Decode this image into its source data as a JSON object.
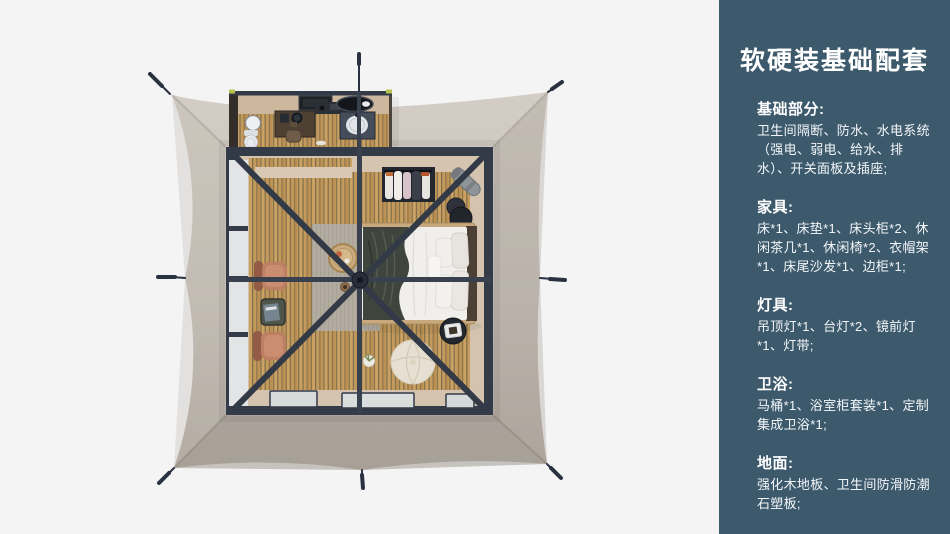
{
  "panel": {
    "title": "软硬装基础配套",
    "sections": [
      {
        "heading": "基础部分:",
        "body": "卫生间隔断、防水、水电系统（强电、弱电、给水、排水）、开关面板及插座;"
      },
      {
        "heading": "家具:",
        "body": "床*1、床垫*1、床头柜*2、休闲茶几*1、休闲椅*2、衣帽架*1、床尾沙发*1、边柜*1;"
      },
      {
        "heading": "灯具:",
        "body": "吊顶灯*1、台灯*2、镜前灯*1、灯带;"
      },
      {
        "heading": "卫浴:",
        "body": "马桶*1、浴室柜套装*1、定制集成卫浴*1;"
      },
      {
        "heading": "地面:",
        "body": "强化木地板、卫生间防滑防潮石塑板;"
      }
    ]
  },
  "colors": {
    "background": "#f4f4f5",
    "panel_background": "#3d5a6d",
    "panel_text": "#ffffff",
    "frame": "#343b48",
    "wood_floor": "#c49b5c",
    "tent_canvas_light": "#d3cdc5",
    "tent_canvas_dark": "#b1a9a0",
    "accent_terracotta": "#bd7f63"
  }
}
